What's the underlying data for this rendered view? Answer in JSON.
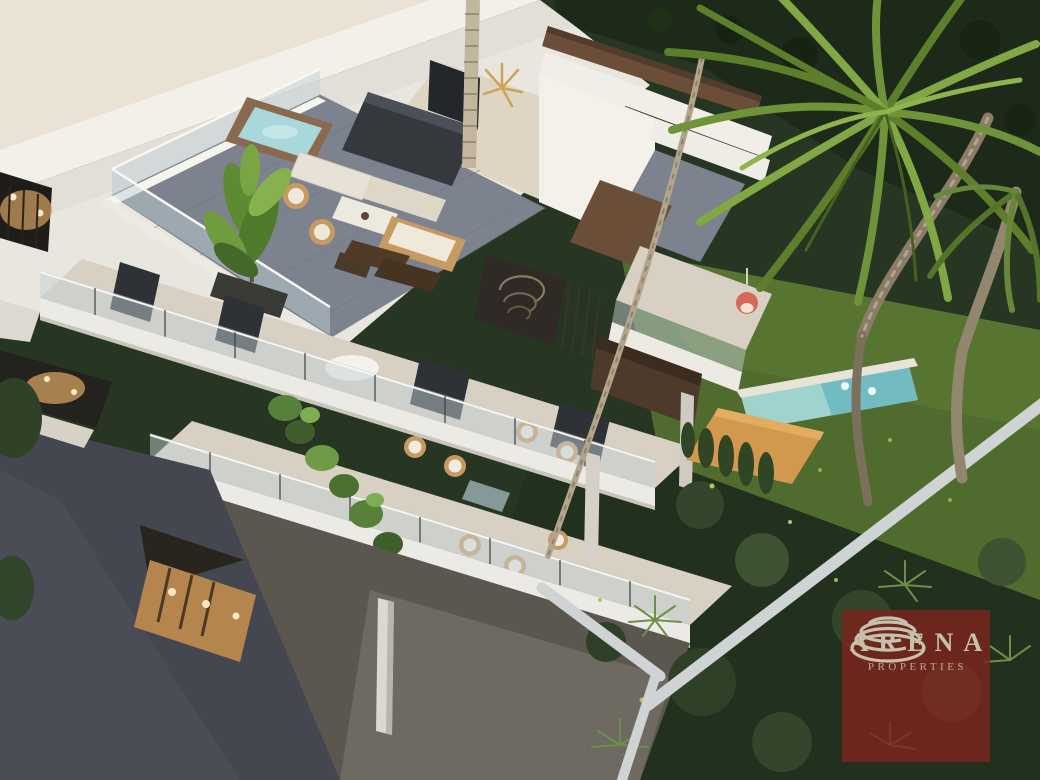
{
  "image": {
    "type": "architectural-rendering",
    "description": "Aerial dusk view of a modern white apartment building with a rooftop terrace (jacuzzi, outdoor kitchen, lounge furniture, large plant), glass-railed balconies with wicker chairs, cascading greenery, a turquoise pool with orange timber deck, lawn and dark landscaped garden, large palm trees, and a grey driveway"
  },
  "watermark": {
    "brand": "ARENA",
    "subtitle": "PROPERTIES",
    "icon": "arena-swirl-icon"
  },
  "colors": {
    "logo-red": "#7c241d",
    "logo-text": "#c6c0ac",
    "sky-cream": "#eae3d5",
    "building-white": "#efece5",
    "floor-beige": "#d8d0c2",
    "roof-deck-gray": "#7d838e",
    "driveway-slate": "#4a4c56",
    "wood-brown": "#6b4e38",
    "deck-orange": "#d2984e",
    "pool-aqua": "#9ed4cd",
    "pool-deep": "#4fa8b8",
    "lawn-green": "#4f6b2d",
    "garden-dark": "#273623",
    "palm-green": "#678c2f",
    "warm-light": "#f5d9a0"
  }
}
